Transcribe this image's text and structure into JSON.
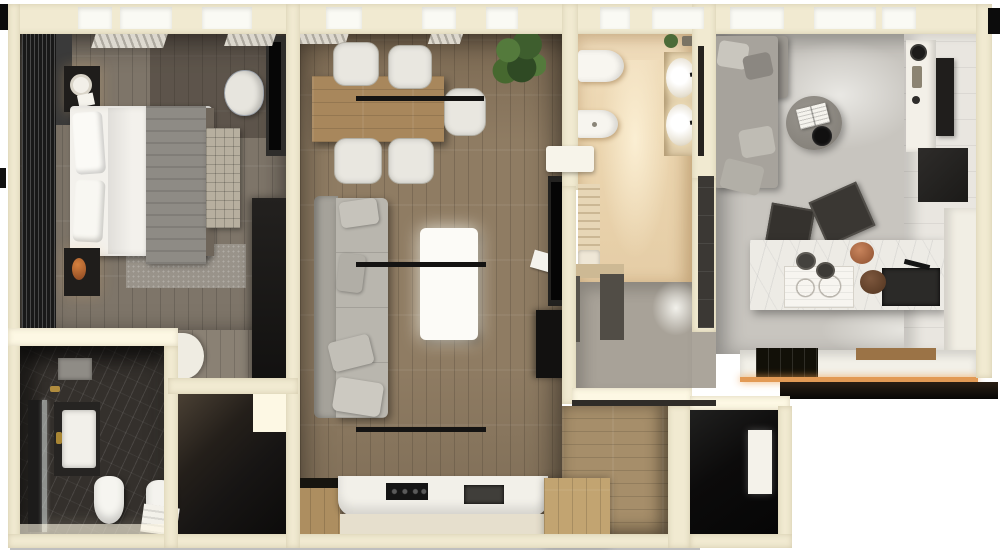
{
  "scene": {
    "title": "Apartment floor plan — photorealistic top-down 3D render",
    "description": "Top-down 3D render of a furnished two-unit apartment: bedroom with wardrobe and double bed, dark marble bathroom with shower, toilet and bidet, dark closet room, central living-dining room with dining table, gray sofa, white coffee table, track lights and kitchen counter, beige bathroom with wall-hung toilet, bidet and double-sink vanity, gray hallway, wood corridor, dark entry with door mat, and a studio room with gray sofa, round pouf, marble kitchen island with cooktop and sink, bar stools and wall shelves."
  },
  "colors": {
    "background": "#ffffff",
    "wall": "#f1ead1",
    "wall_lit": "#fdf8e4",
    "window": "#fafaf4",
    "floor_bedroom": "#7e7569",
    "floor_living": "#8f7c63",
    "floor_corridor": "#a68e6a",
    "bath_dark": "#34302c",
    "bath_beige": "#ecd8b6",
    "hall_gray": "#a8a298",
    "floor_right": "#c8c5bf",
    "dark_room": "#171514",
    "entry_dark": "#0c0b0b",
    "sofa_gray": "#b9b6ae",
    "bed_white": "#f3f1ec",
    "blanket_gray": "#8e8b85",
    "wood_mid": "#a8875c",
    "wood_light": "#c2a471",
    "marble_white": "#edebe5",
    "black_item": "#141312",
    "amber_glow": "#e29a55",
    "plant_green": "#4a6b37"
  },
  "rooms": [
    {
      "id": "bedroom",
      "furniture": [
        "louvered-wardrobe",
        "double-bed",
        "gray-blanket",
        "nightstand-top",
        "nightstand-bottom",
        "tufted-bench",
        "rug",
        "tv-panel",
        "chair",
        "tall-wardrobe",
        "curtains"
      ]
    },
    {
      "id": "bathroom-dark-marble",
      "furniture": [
        "shower",
        "shower-glass",
        "vanity-sink",
        "toilet",
        "bidet",
        "towel"
      ]
    },
    {
      "id": "closet-room",
      "furniture": []
    },
    {
      "id": "living-dining-room",
      "furniture": [
        "dining-table",
        "dining-chairs",
        "plant",
        "track-light-bars",
        "corner-sofa",
        "pillows",
        "coffee-table",
        "wall-tv",
        "media-cabinet",
        "kitchen-counter",
        "cooktop",
        "kitchen-sink",
        "wood-cabinets",
        "magazine",
        "open-door"
      ]
    },
    {
      "id": "bathroom-beige",
      "furniture": [
        "wall-hung-toilet",
        "wall-hung-bidet",
        "double-sink-vanity",
        "mirror-strip",
        "shelf-with-plant",
        "laundry-counter",
        "laundry-cabinets"
      ]
    },
    {
      "id": "hallway-gray",
      "furniture": []
    },
    {
      "id": "corridor-wood",
      "furniture": [
        "wood-cabinet"
      ]
    },
    {
      "id": "entry-dark",
      "furniture": [
        "door-mat"
      ]
    },
    {
      "id": "studio-room",
      "furniture": [
        "corner-sofa",
        "round-pouf",
        "open-book",
        "black-tray",
        "kitchen-island",
        "island-cooktop",
        "island-sink",
        "bowls",
        "bar-stools",
        "wall-shelf-column",
        "dark-wall-panel",
        "wall-cabinet",
        "bottom-counter",
        "black-hob",
        "cutting-board",
        "led-strip"
      ]
    }
  ]
}
